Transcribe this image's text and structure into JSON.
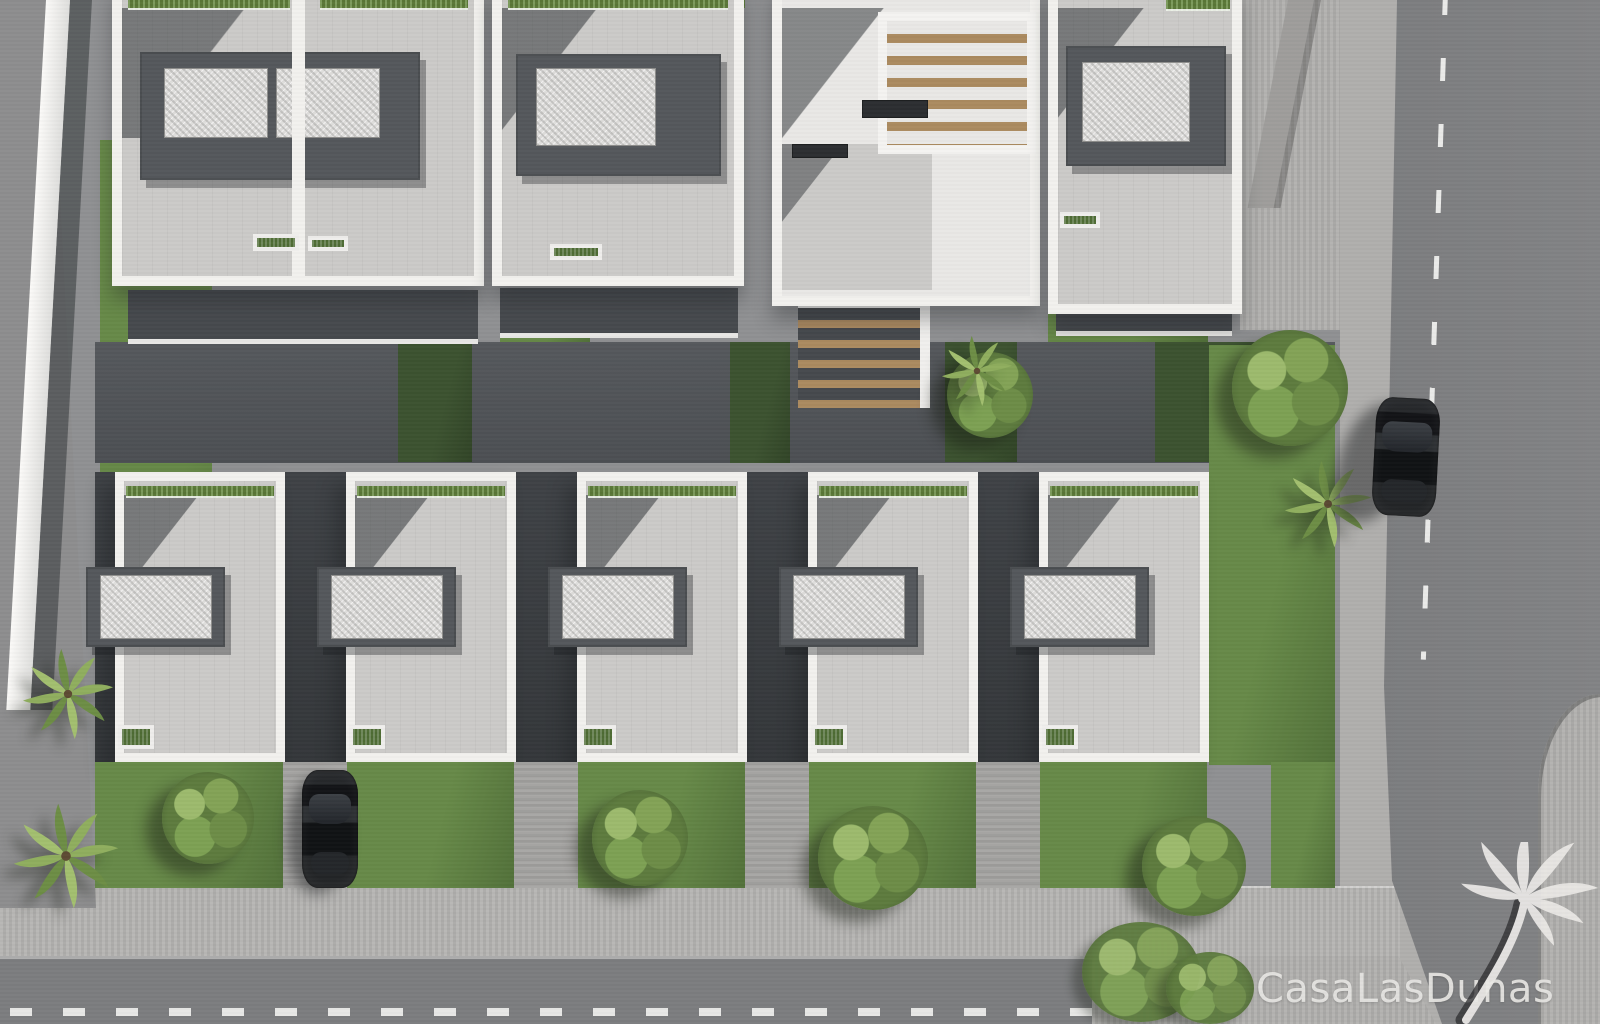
{
  "watermark": {
    "text": "CasaLasDunas",
    "icon": "palm-tree-icon"
  },
  "scene": {
    "description": "Aerial 3D architectural render of a modern villa development: two rows of white flat-roof houses with gray roof terraces, gravel roof patches and green hedges, lawned gardens with trees and palms, a dark courtyard lane, surrounding sidewalks and asphalt streets with dashed white markings, one black car driving on the right street and one parked between houses."
  },
  "palette": {
    "pavement": "#b0afad",
    "pavement_sun": "#b4b3b1",
    "plot": "#8f9092",
    "asphalt": "#7c7d7f",
    "asphalt_left": "#8d8d8e",
    "wall": "#f2f1ee",
    "terrace": "#cbcac8",
    "volume": "#54575b",
    "gravel": "#dedddb",
    "grass": "#678948",
    "grass_dark": "#3c5230",
    "hedge": "#65883f",
    "wood": "#ab8a60",
    "car": "#1a1b1d",
    "marking": "#f4f4f2",
    "watermark": "#e8e7e4"
  }
}
